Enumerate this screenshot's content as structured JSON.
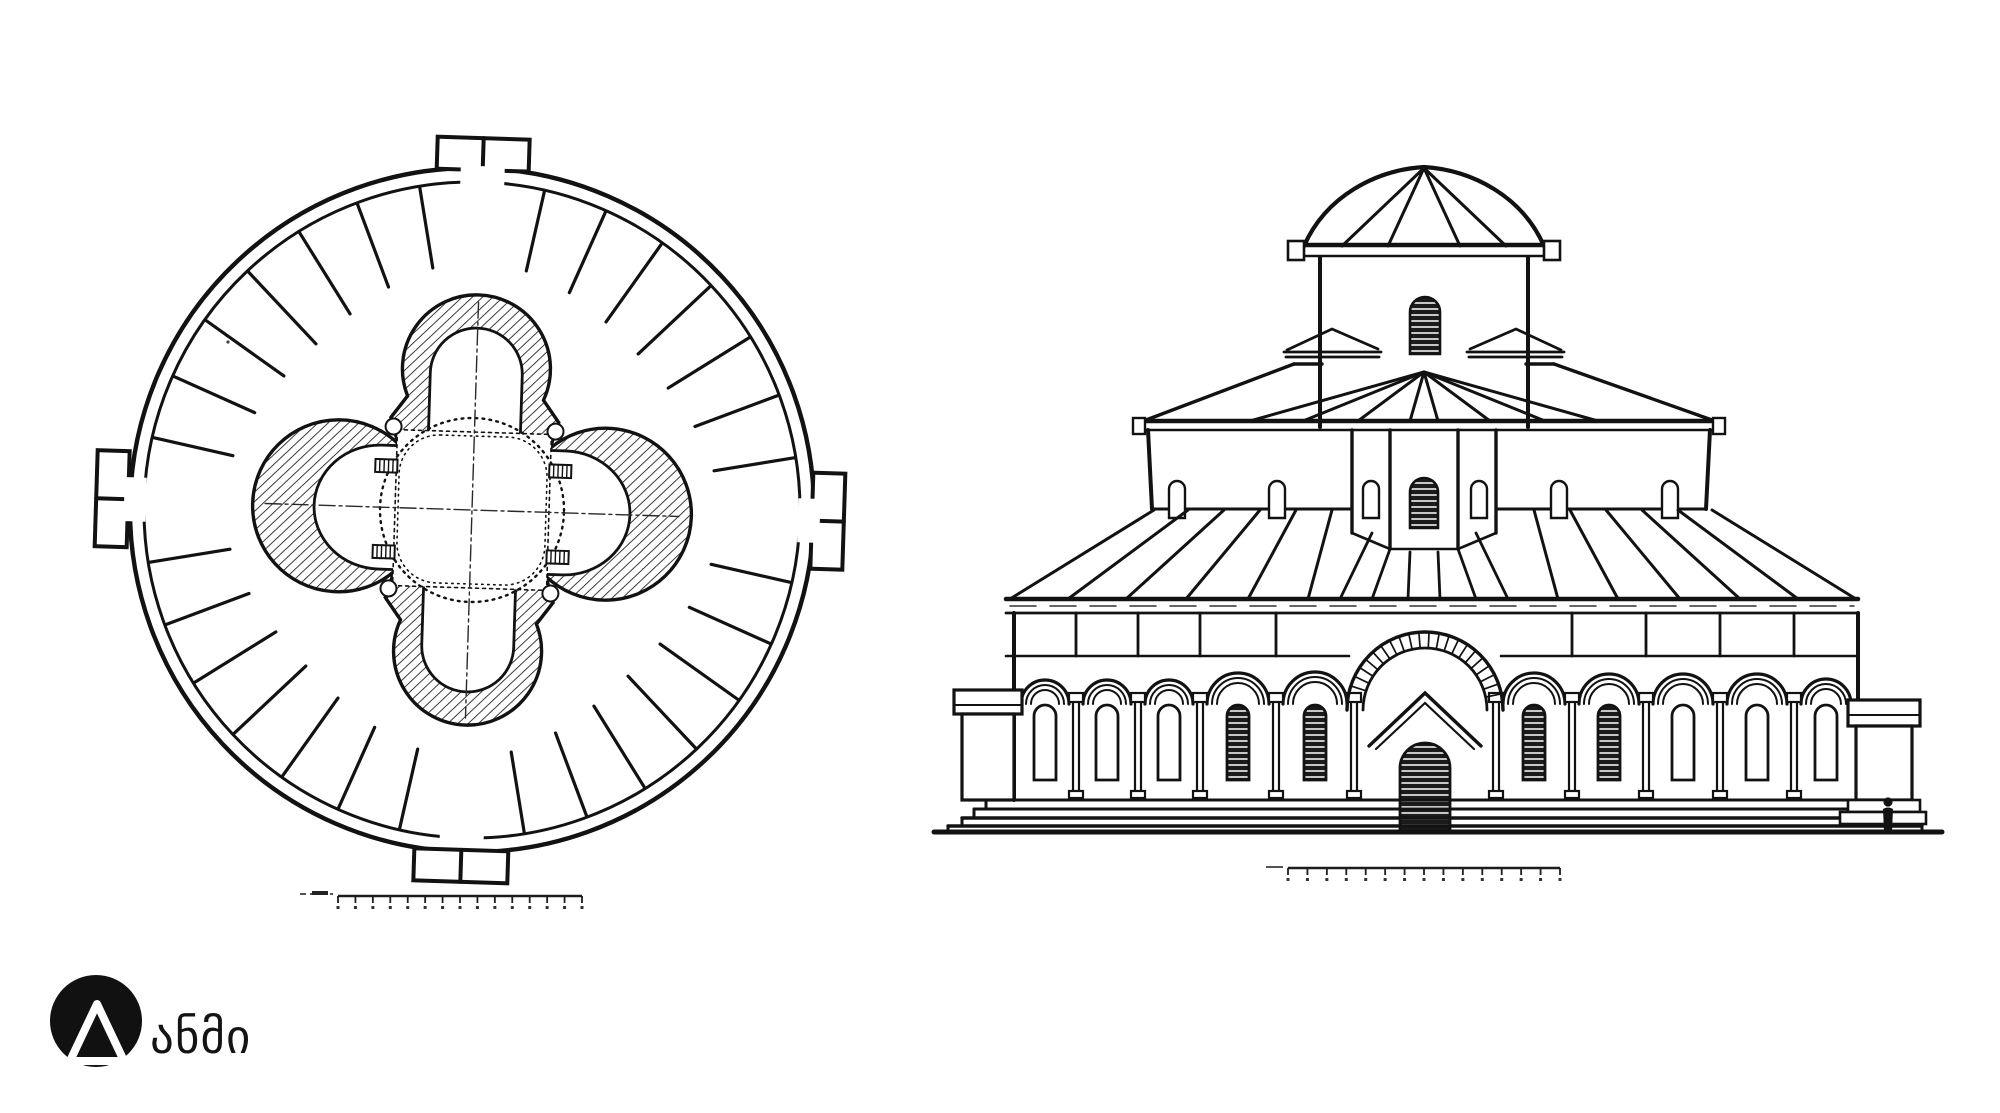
{
  "page": {
    "background": "#ffffff",
    "ink": "#121212"
  },
  "logo": {
    "text": "ანმი",
    "mark": "mountain-triangle-in-circle",
    "color": "#111111"
  },
  "drawings": {
    "floor_plan": {
      "kind": "circular tetraconch plan",
      "porches": 4,
      "radial_lines": 28,
      "scale_bar_ticks": 15
    },
    "elevation": {
      "kind": "three-tier domed facade",
      "arcade_windows": 10,
      "scale_bar_ticks": 15,
      "has_human_figure": true
    }
  }
}
